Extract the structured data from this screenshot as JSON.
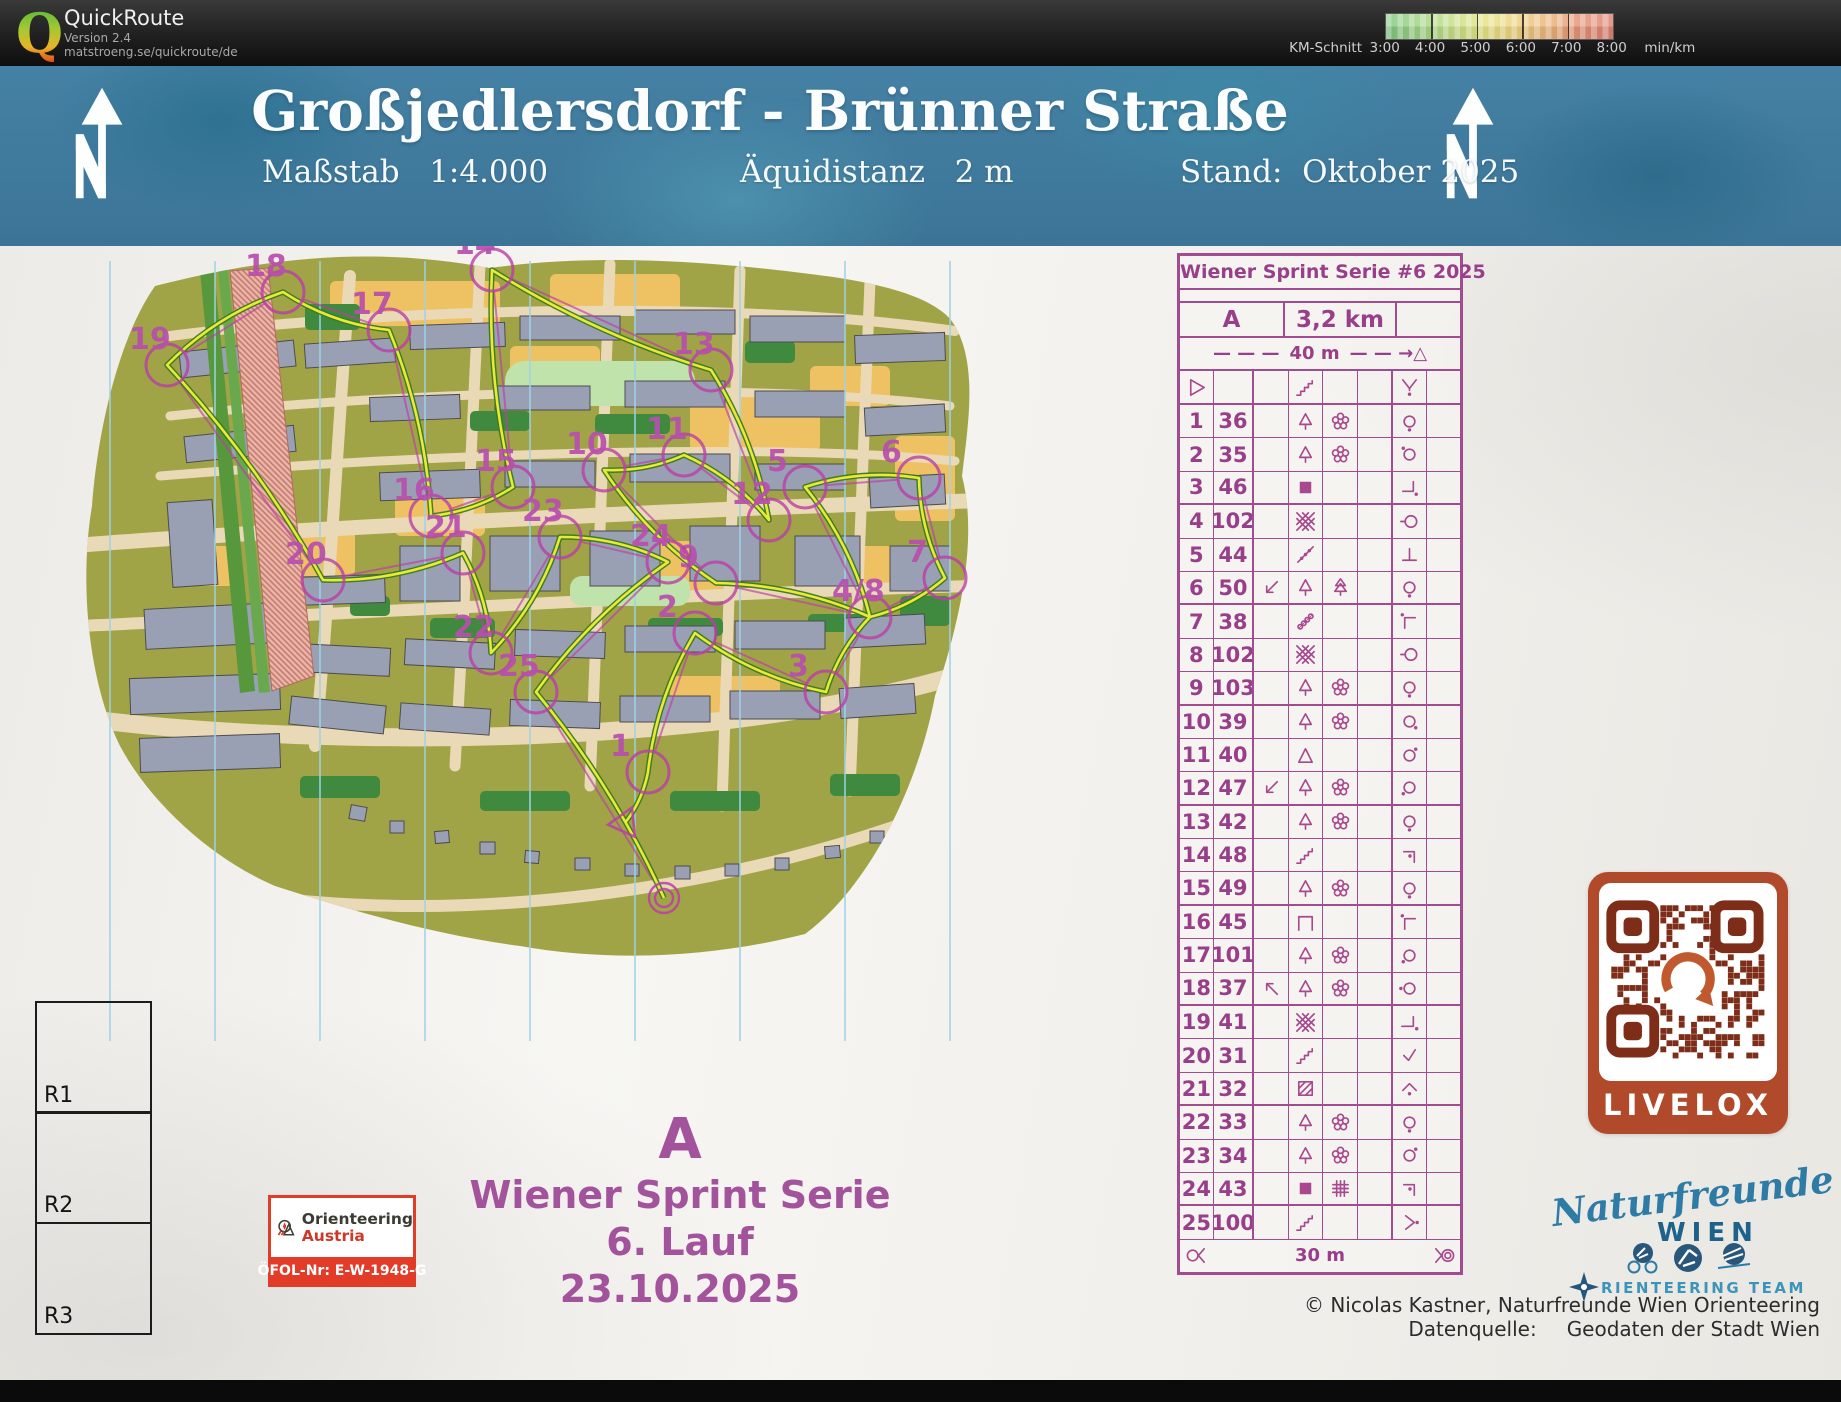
{
  "app": {
    "logo_letter": "Q",
    "title": "QuickRoute",
    "version": "Version 2.4",
    "url": "matstroeng.se/quickroute/de"
  },
  "scalebar": {
    "label": "KM-Schnitt",
    "ticks": [
      "3:00",
      "4:00",
      "5:00",
      "6:00",
      "7:00",
      "8:00"
    ],
    "unit": "min/km",
    "colors": [
      "#7fc67f",
      "#e4e383",
      "#df8273"
    ]
  },
  "banner": {
    "title": "Großjedlersdorf - Brünner Straße",
    "scale_label": "Maßstab",
    "scale_value": "1:4.000",
    "equidistance_label": "Äquidistanz",
    "equidistance_value": "2 m",
    "stand_label": "Stand:",
    "stand_value": "Oktober 2025"
  },
  "map": {
    "course_letter": "A",
    "course_color": "#b93fa6",
    "gps_color": "#e9e93a",
    "start": {
      "x": 575,
      "y": 577
    },
    "finish": {
      "x": 614,
      "y": 652
    },
    "controls": [
      {
        "label": "1",
        "x": 598,
        "y": 526
      },
      {
        "label": "2",
        "x": 645,
        "y": 387
      },
      {
        "label": "3",
        "x": 776,
        "y": 446
      },
      {
        "label": "4/8",
        "x": 820,
        "y": 371
      },
      {
        "label": "5",
        "x": 755,
        "y": 241
      },
      {
        "label": "6",
        "x": 869,
        "y": 232
      },
      {
        "label": "7",
        "x": 895,
        "y": 332
      },
      {
        "label": "9",
        "x": 666,
        "y": 337
      },
      {
        "label": "10",
        "x": 554,
        "y": 224
      },
      {
        "label": "11",
        "x": 634,
        "y": 209
      },
      {
        "label": "12",
        "x": 719,
        "y": 274
      },
      {
        "label": "13",
        "x": 661,
        "y": 124
      },
      {
        "label": "14",
        "x": 442,
        "y": 24
      },
      {
        "label": "15",
        "x": 463,
        "y": 241
      },
      {
        "label": "16",
        "x": 381,
        "y": 270
      },
      {
        "label": "17",
        "x": 339,
        "y": 84
      },
      {
        "label": "18",
        "x": 233,
        "y": 46
      },
      {
        "label": "19",
        "x": 117,
        "y": 119
      },
      {
        "label": "20",
        "x": 273,
        "y": 334
      },
      {
        "label": "21",
        "x": 413,
        "y": 307
      },
      {
        "label": "22",
        "x": 441,
        "y": 407
      },
      {
        "label": "23",
        "x": 510,
        "y": 291
      },
      {
        "label": "24",
        "x": 618,
        "y": 316
      },
      {
        "label": "25",
        "x": 486,
        "y": 446
      }
    ],
    "route_order": [
      "1",
      "2",
      "3",
      "4/8",
      "5",
      "6",
      "7",
      "4/8",
      "9",
      "10",
      "11",
      "12",
      "13",
      "14",
      "15",
      "16",
      "17",
      "18",
      "19",
      "20",
      "21",
      "22",
      "23",
      "24",
      "25"
    ]
  },
  "control_card": {
    "title": "Wiener Sprint Serie #6 2025",
    "course": "A",
    "length": "3,2 km",
    "climb": "",
    "start_distance_prefix": "— — —",
    "start_distance": "40 m",
    "start_distance_suffix": "— — →△",
    "start_row": {
      "a": "start-triangle",
      "d": "stairs",
      "g": "junction"
    },
    "rows": [
      {
        "n": "1",
        "code": "36",
        "c": "",
        "d": "tree",
        "e": "flower",
        "f": "",
        "g": "circle-dot-s"
      },
      {
        "n": "2",
        "code": "35",
        "c": "",
        "d": "tree",
        "e": "flower",
        "f": "",
        "g": "circle-dot-nw"
      },
      {
        "n": "3",
        "code": "46",
        "c": "",
        "d": "building",
        "e": "",
        "f": "",
        "g": "corner-se-dot"
      },
      {
        "n": "4",
        "code": "102",
        "c": "",
        "d": "hatch",
        "e": "",
        "f": "",
        "g": "circle-crossbar"
      },
      {
        "n": "5",
        "code": "44",
        "c": "",
        "d": "fence",
        "e": "",
        "f": "",
        "g": "tee"
      },
      {
        "n": "6",
        "code": "50",
        "c": "arrow-sw",
        "d": "tree",
        "e": "conifer",
        "f": "",
        "g": "circle-dot-s"
      },
      {
        "n": "7",
        "code": "38",
        "c": "",
        "d": "chain",
        "e": "",
        "f": "",
        "g": "corner-nw-dot"
      },
      {
        "n": "8",
        "code": "102",
        "c": "",
        "d": "hatch",
        "e": "",
        "f": "",
        "g": "circle-crossbar"
      },
      {
        "n": "9",
        "code": "103",
        "c": "",
        "d": "tree",
        "e": "flower",
        "f": "",
        "g": "circle-dot-s"
      },
      {
        "n": "10",
        "code": "39",
        "c": "",
        "d": "tree",
        "e": "flower",
        "f": "",
        "g": "circle-dot-se"
      },
      {
        "n": "11",
        "code": "40",
        "c": "",
        "d": "triangle",
        "e": "",
        "f": "",
        "g": "circle-dot-ne"
      },
      {
        "n": "12",
        "code": "47",
        "c": "arrow-sw",
        "d": "tree",
        "e": "flower",
        "f": "",
        "g": "circle-dot-sw"
      },
      {
        "n": "13",
        "code": "42",
        "c": "",
        "d": "tree",
        "e": "flower",
        "f": "",
        "g": "circle-dot-s"
      },
      {
        "n": "14",
        "code": "48",
        "c": "",
        "d": "stairs",
        "e": "",
        "f": "",
        "g": "corner-ne-dot"
      },
      {
        "n": "15",
        "code": "49",
        "c": "",
        "d": "tree",
        "e": "flower",
        "f": "",
        "g": "circle-dot-s"
      },
      {
        "n": "16",
        "code": "45",
        "c": "",
        "d": "canopy",
        "e": "",
        "f": "",
        "g": "corner-nw-dot"
      },
      {
        "n": "17",
        "code": "101",
        "c": "",
        "d": "tree",
        "e": "flower",
        "f": "",
        "g": "circle-dot-sw"
      },
      {
        "n": "18",
        "code": "37",
        "c": "arrow-nw",
        "d": "tree",
        "e": "flower",
        "f": "",
        "g": "circle-dot-w"
      },
      {
        "n": "19",
        "code": "41",
        "c": "",
        "d": "hatch",
        "e": "",
        "f": "",
        "g": "tee-dot"
      },
      {
        "n": "20",
        "code": "31",
        "c": "",
        "d": "stairs",
        "e": "",
        "f": "",
        "g": "check"
      },
      {
        "n": "21",
        "code": "32",
        "c": "",
        "d": "hatch-square",
        "e": "",
        "f": "",
        "g": "caret-dot"
      },
      {
        "n": "22",
        "code": "33",
        "c": "",
        "d": "tree",
        "e": "flower",
        "f": "",
        "g": "circle-dot-s"
      },
      {
        "n": "23",
        "code": "34",
        "c": "",
        "d": "tree",
        "e": "flower",
        "f": "",
        "g": "circle-dot-ne"
      },
      {
        "n": "24",
        "code": "43",
        "c": "",
        "d": "building",
        "e": "grid",
        "f": "",
        "g": "corner-ne-dot"
      },
      {
        "n": "25",
        "code": "100",
        "c": "",
        "d": "stairs",
        "e": "",
        "f": "",
        "g": "angle-dot"
      }
    ],
    "finish_row": {
      "left_icon": "finish-left",
      "distance": "30 m",
      "right_icon": "finish-right"
    }
  },
  "registration": {
    "boxes": [
      "R1",
      "R2",
      "R3"
    ]
  },
  "event_block": {
    "course": "A",
    "series": "Wiener Sprint Serie",
    "run": "6. Lauf",
    "date": "23.10.2025"
  },
  "austria_logo": {
    "line1": "Orienteering",
    "line2": "Austria",
    "code": "ÖFOL-Nr: E-W-1948-G"
  },
  "livelox": {
    "label": "LIVELOX"
  },
  "club_logo": {
    "script": "Naturfreunde",
    "city": "WIEN",
    "team": "RIENTEERING TEAM"
  },
  "credits": {
    "line1": "© Nicolas Kastner, Naturfreunde Wien Orienteering",
    "line2_label": "Datenquelle:",
    "line2_value": "Geodaten der Stadt Wien"
  }
}
